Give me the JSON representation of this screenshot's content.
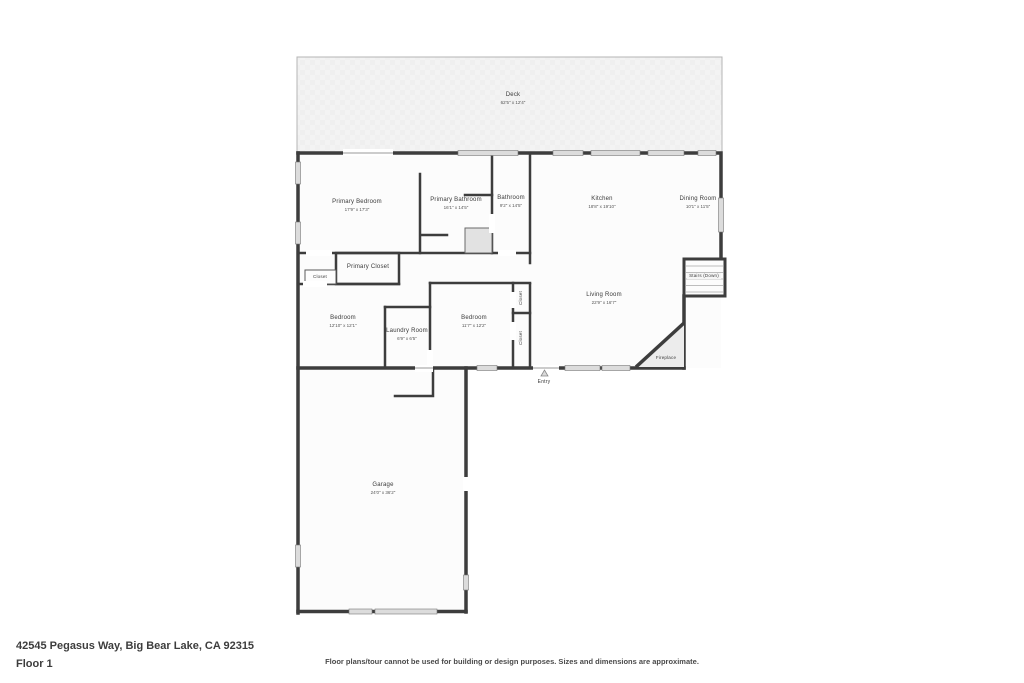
{
  "footer": {
    "address": "42545 Pegasus Way, Big Bear Lake, CA 92315",
    "floor_label": "Floor 1",
    "disclaimer": "Floor plans/tour cannot be used for building or design purposes. Sizes and dimensions are approximate."
  },
  "colors": {
    "wall": "#3d3d3d",
    "deck_fill": "#f3f3f3",
    "window_fill": "#dcdcdc",
    "fireplace_fill": "#ececec",
    "interior_fill": "#fcfcfc"
  },
  "rooms": {
    "deck": {
      "name": "Deck",
      "dims": "62'5\" x 12'4\""
    },
    "primary_bedroom": {
      "name": "Primary Bedroom",
      "dims": "17'9\" x 17'3\""
    },
    "primary_bathroom": {
      "name": "Primary Bathroom",
      "dims": "16'1\" x 14'5\""
    },
    "bathroom": {
      "name": "Bathroom",
      "dims": "9'2\" x 14'5\""
    },
    "kitchen": {
      "name": "Kitchen",
      "dims": "18'8\" x 19'10\""
    },
    "dining_room": {
      "name": "Dining Room",
      "dims": "10'1\" x 11'5\""
    },
    "stairs": {
      "name": "Stairs (Down)"
    },
    "living_room": {
      "name": "Living Room",
      "dims": "22'9\" x 16'7\""
    },
    "primary_closet": {
      "name": "Primary Closet"
    },
    "hall_closet": {
      "name": "Closet"
    },
    "bedroom_left": {
      "name": "Bedroom",
      "dims": "12'10\" x 12'1\""
    },
    "laundry_room": {
      "name": "Laundry Room",
      "dims": "6'9\" x 6'5\""
    },
    "bedroom_right": {
      "name": "Bedroom",
      "dims": "11'7\" x 12'2\""
    },
    "closet_upper": {
      "name": "Closet"
    },
    "closet_lower": {
      "name": "Closet"
    },
    "fireplace": {
      "name": "Fireplace"
    },
    "entry": {
      "name": "Entry"
    },
    "garage": {
      "name": "Garage",
      "dims": "24'0\" x 36'2\""
    }
  }
}
